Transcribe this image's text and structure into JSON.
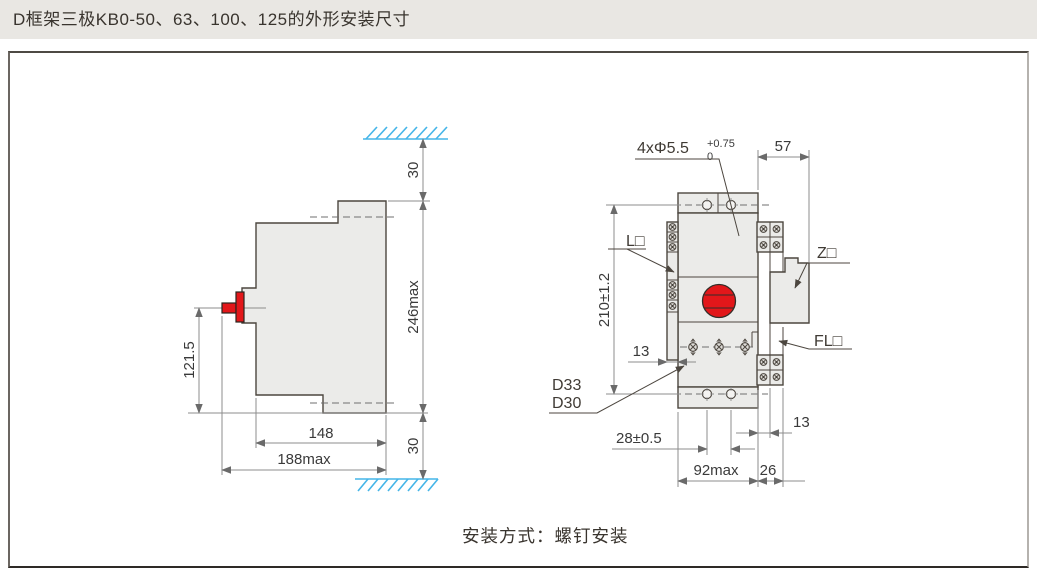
{
  "header": {
    "title": "D框架三极KB0-50、63、100、125的外形安装尺寸"
  },
  "caption": "安装方式：螺钉安装",
  "colors": {
    "accent_red": "#e2171a",
    "hatch_blue": "#45b5e8",
    "outline": "#4c463f",
    "dim_line": "#8c8c8c"
  },
  "side_view": {
    "top_clearance": "30",
    "height_max": "246max",
    "handle_center_height": "121.5",
    "depth": "148",
    "depth_max": "188max",
    "bottom_clearance": "30"
  },
  "front_view": {
    "mounting_holes": "4xΦ5.5",
    "holes_tol_upper": "+0.75",
    "holes_tol_lower": "0",
    "top_depth": "57",
    "mounting_hole_vspacing": "210±1.2",
    "terminal_offset": "13",
    "frame_d33": "D33",
    "frame_d30": "D30",
    "mounting_hole_hspacing": "28±0.5",
    "width_max": "92max",
    "side_width": "26",
    "rail_width": "13",
    "label_l": "L□",
    "label_z": "Z□",
    "label_fl": "FL□"
  }
}
